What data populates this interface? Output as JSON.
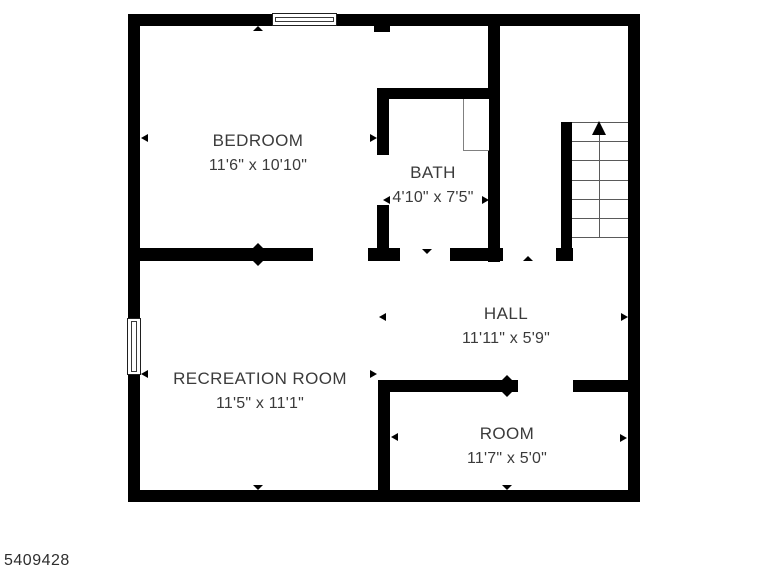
{
  "plan_id": "5409428",
  "rooms": {
    "bedroom": {
      "name": "BEDROOM",
      "dims": "11'6\" x 10'10\""
    },
    "bath": {
      "name": "BATH",
      "dims": "4'10\" x 7'5\""
    },
    "hall": {
      "name": "HALL",
      "dims": "11'11\" x 5'9\""
    },
    "recreation": {
      "name": "RECREATION ROOM",
      "dims": "11'5\" x 11'1\""
    },
    "room": {
      "name": "ROOM",
      "dims": "11'7\" x 5'0\""
    }
  },
  "stairs": {
    "steps": 6,
    "direction_icon": "up-arrow"
  },
  "colors": {
    "wall": "#000000",
    "text": "#3b3b3b",
    "line": "#5a5a5a",
    "background": "#ffffff"
  }
}
